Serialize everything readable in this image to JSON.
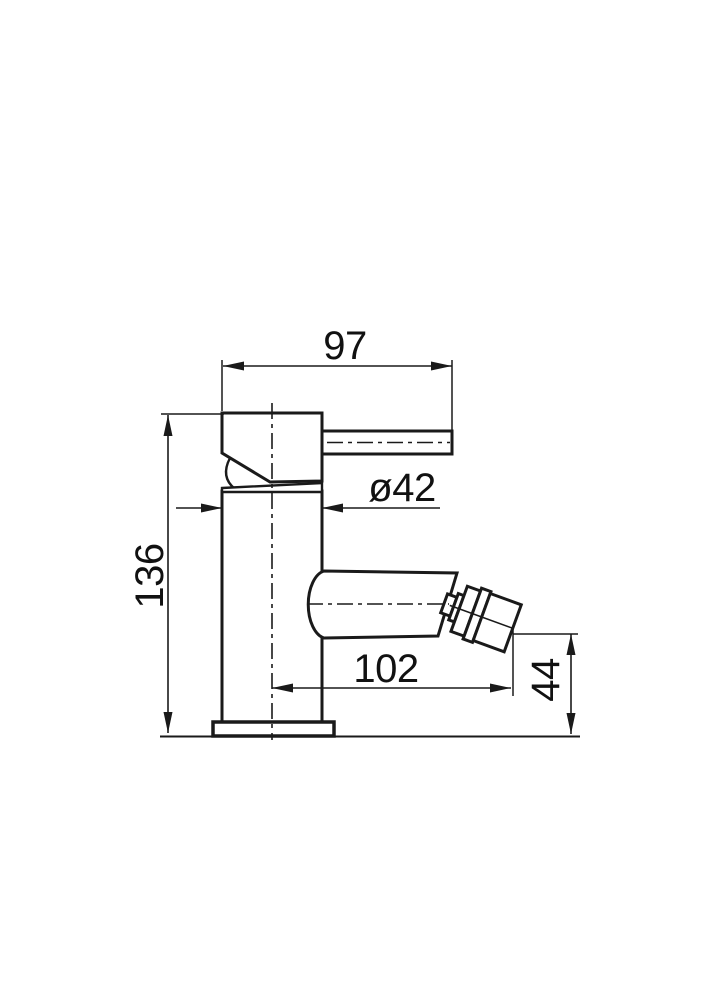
{
  "drawing": {
    "kind": "technical-dimension-drawing",
    "colors": {
      "line": "#1a1a1a",
      "background": "#ffffff"
    },
    "dimensions": {
      "handle_length": {
        "label": "97"
      },
      "body_diameter": {
        "label": "ø42"
      },
      "total_height": {
        "label": "136"
      },
      "spout_reach": {
        "label": "102"
      },
      "outlet_height": {
        "label": "44"
      }
    }
  }
}
